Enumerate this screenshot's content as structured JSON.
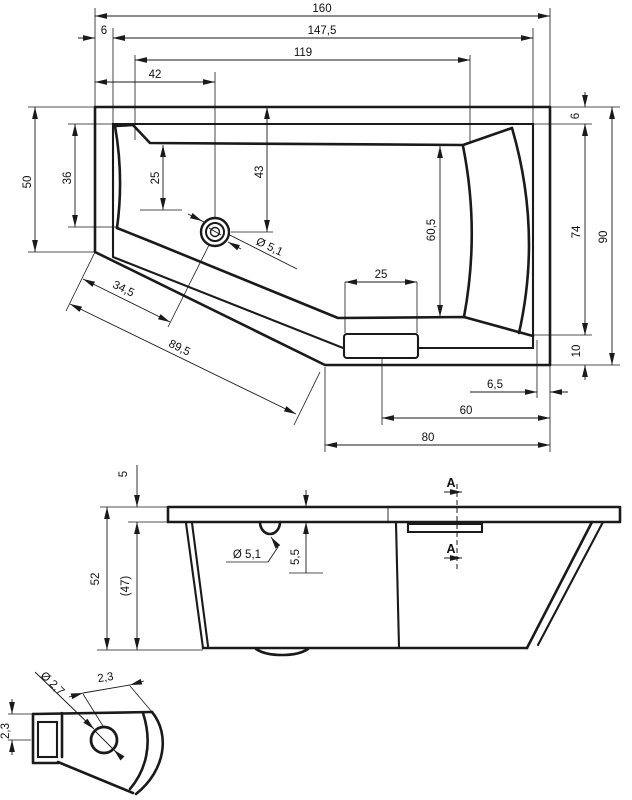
{
  "colors": {
    "line": "#1a1a1a",
    "background": "#ffffff"
  },
  "plan_view": {
    "dims": {
      "total_width": "160",
      "inner_width": "147,5",
      "left_rim_offset": "6",
      "basin_width": "119",
      "drain_offset_x": "42",
      "left_end_width": "50",
      "left_inner_width": "36",
      "backrest_width": "25",
      "drain_offset_y": "43",
      "drain_diameter": "Ø 5,1",
      "basin_inner_height": "60,5",
      "seat_block_width": "25",
      "diagonal_to_drain": "34,5",
      "diagonal_total": "89,5",
      "right_rim_offset_top": "6",
      "right_inner_height": "74",
      "right_total_height": "90",
      "right_rim_offset_bottom": "10",
      "outlet_offset": "6,5",
      "seat_to_edge": "60",
      "bottom_width": "80"
    }
  },
  "side_view": {
    "dims": {
      "rim_thickness": "5",
      "total_height": "52",
      "inner_height": "(47)",
      "overflow_diameter": "Ø 5,1",
      "overflow_depth": "5,5"
    },
    "section_label": "A"
  },
  "detail_view": {
    "dims": {
      "hole_diameter": "Ø 2,7",
      "hole_offset_diag": "2,3",
      "hole_offset_vert": "2,3"
    }
  }
}
